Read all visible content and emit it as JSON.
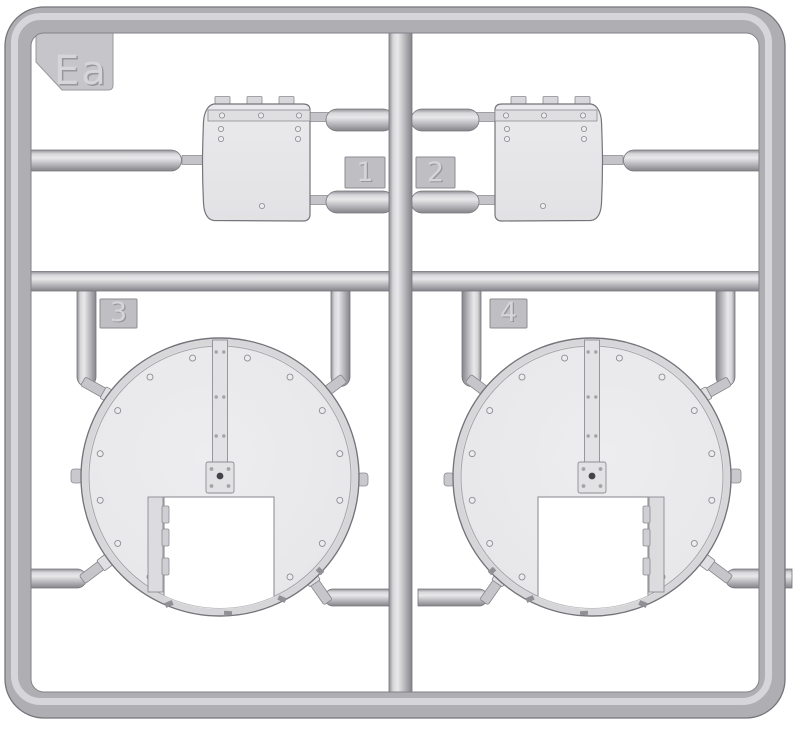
{
  "sprue": {
    "label": "Ea",
    "part_numbers": [
      "1",
      "2",
      "3",
      "4"
    ]
  },
  "colors": {
    "background": "#ffffff",
    "plastic_base": "#aeaeb3",
    "plastic_light": "#e9e9eb",
    "plastic_highlight": "#dddde0",
    "plastic_shadow": "#8a8a8f",
    "outline": "#76767c",
    "tag_fill": "#bfbfc3",
    "emboss_dark": "#97979c",
    "emboss_light": "#d6d6d9"
  }
}
